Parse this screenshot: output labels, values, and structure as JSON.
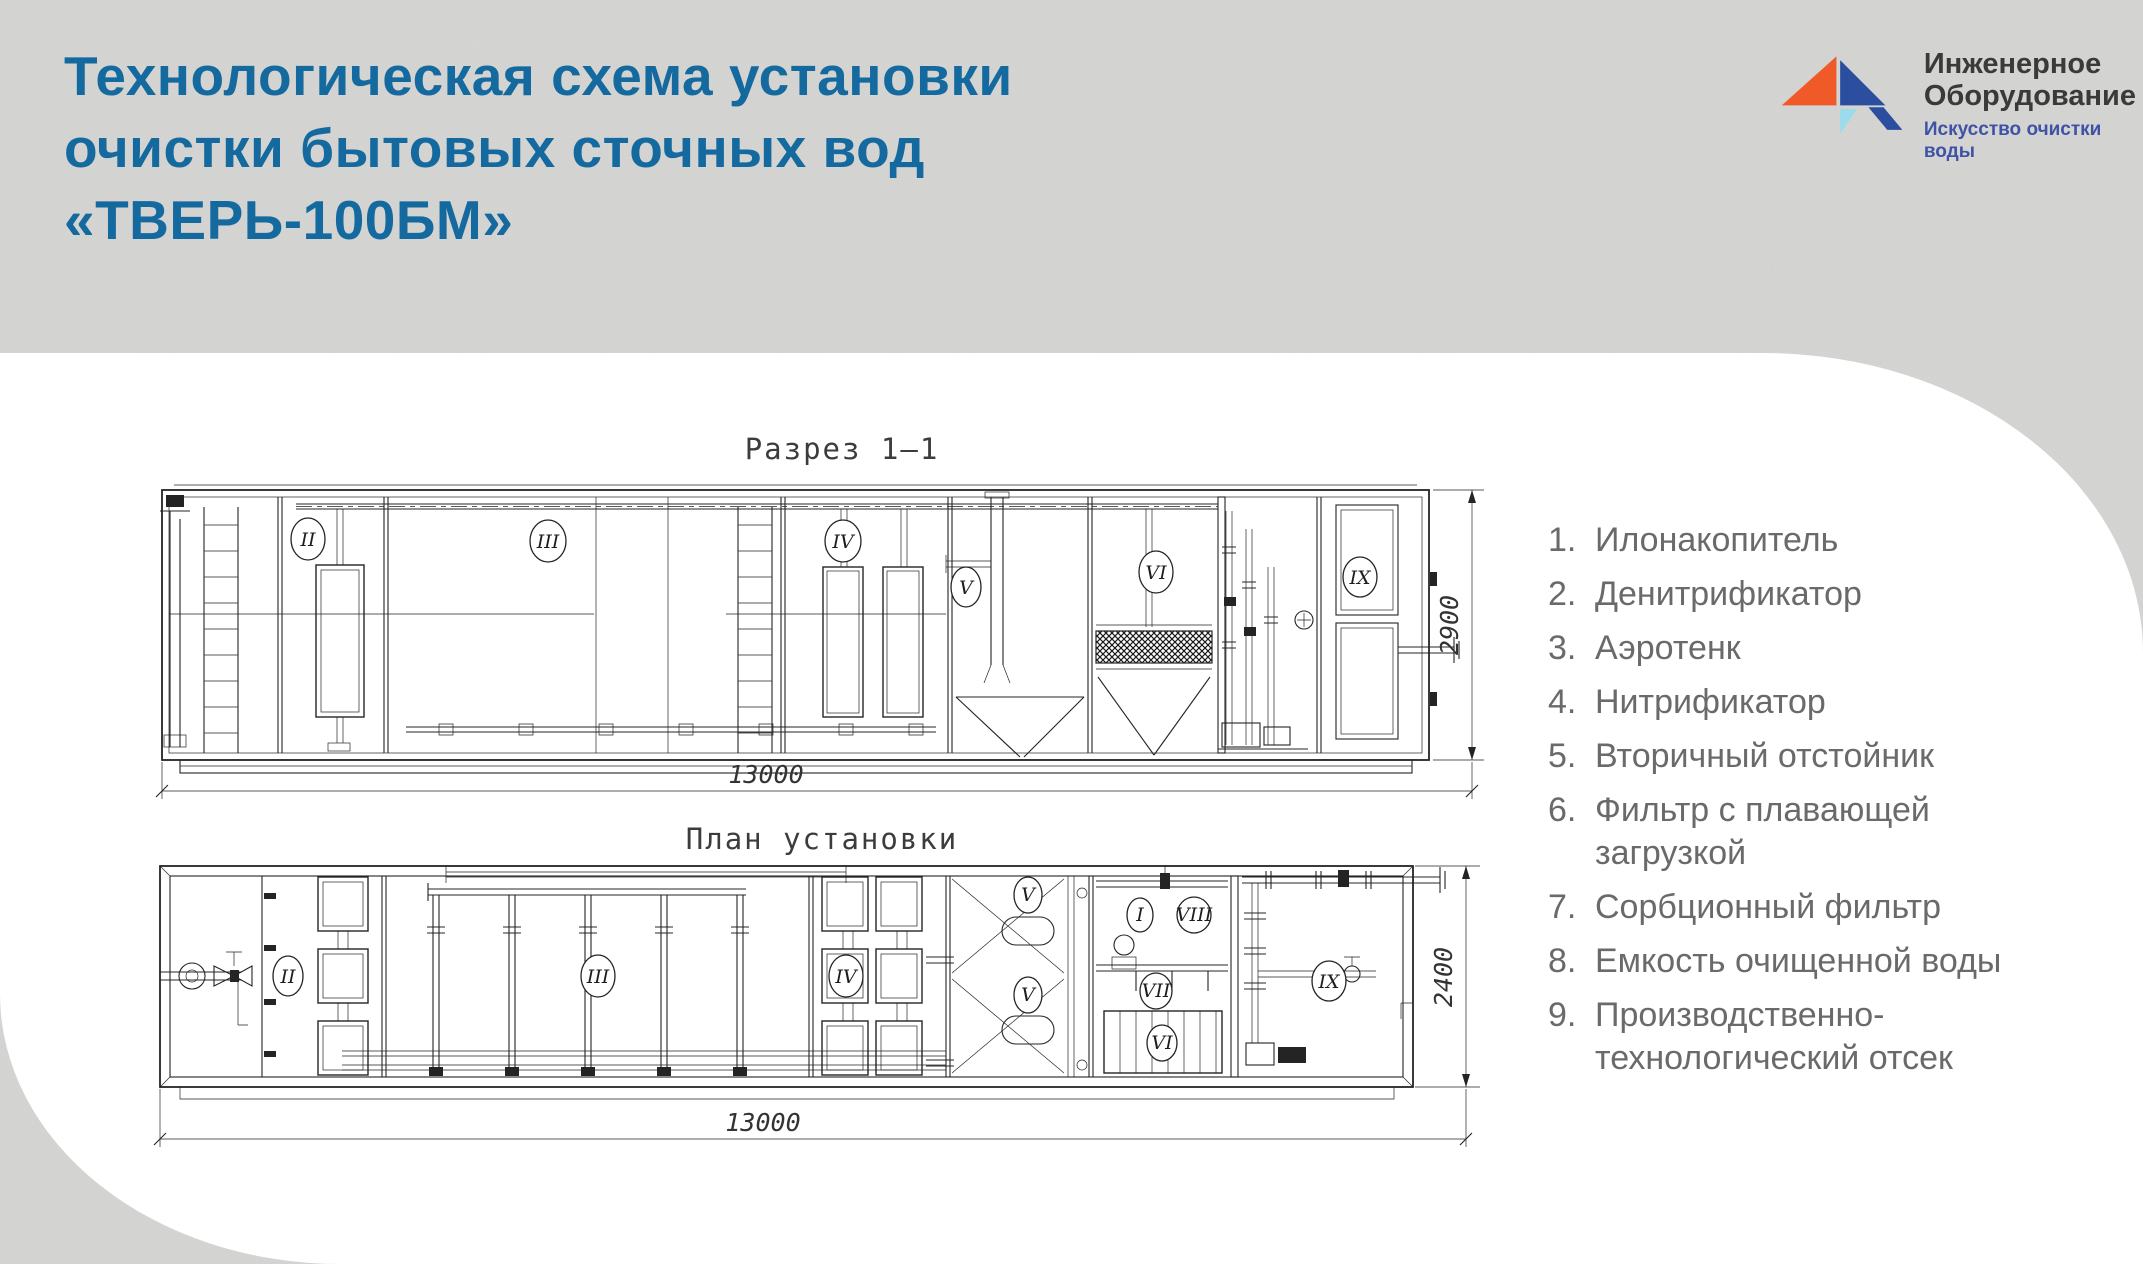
{
  "page": {
    "title": "Технологическая схема установки\nочистки бытовых сточных вод\n«ТВЕРЬ-100БМ»"
  },
  "logo": {
    "line1": "Инженерное",
    "line2": "Оборудование",
    "tagline": "Искусство очистки воды"
  },
  "drawings": {
    "section": {
      "title": "Разрез  1–1",
      "dim_length": "13000",
      "dim_height": "2900",
      "labels": [
        "II",
        "III",
        "IV",
        "V",
        "VI",
        "IX"
      ]
    },
    "plan": {
      "title": "План установки",
      "dim_length": "13000",
      "dim_height": "2400",
      "labels": [
        "II",
        "III",
        "IV",
        "V",
        "V",
        "I",
        "VIII",
        "VII",
        "VI",
        "IX"
      ]
    }
  },
  "legend": {
    "items": [
      {
        "n": "1.",
        "t": "Илонакопитель"
      },
      {
        "n": "2.",
        "t": "Денитрификатор"
      },
      {
        "n": "3.",
        "t": "Аэротенк"
      },
      {
        "n": "4.",
        "t": "Нитрификатор"
      },
      {
        "n": "5.",
        "t": "Вторичный отстойник"
      },
      {
        "n": "6.",
        "t": "Фильтр с плавающей\nзагрузкой"
      },
      {
        "n": "7.",
        "t": "Сорбционный фильтр"
      },
      {
        "n": "8.",
        "t": "Емкость очищенной воды"
      },
      {
        "n": "9.",
        "t": "Производственно-\nтехнологический отсек"
      }
    ]
  },
  "colors": {
    "title_blue": "#14699f",
    "tagline_blue": "#3f53a6",
    "logo_orange": "#f05a28",
    "logo_navy": "#2c4e9e",
    "logo_cyan": "#9adcec",
    "legend_gray": "#6a6a6a",
    "background_gray": "#d7d7d5",
    "panel_white": "#ffffff",
    "line_dark": "#242424"
  }
}
